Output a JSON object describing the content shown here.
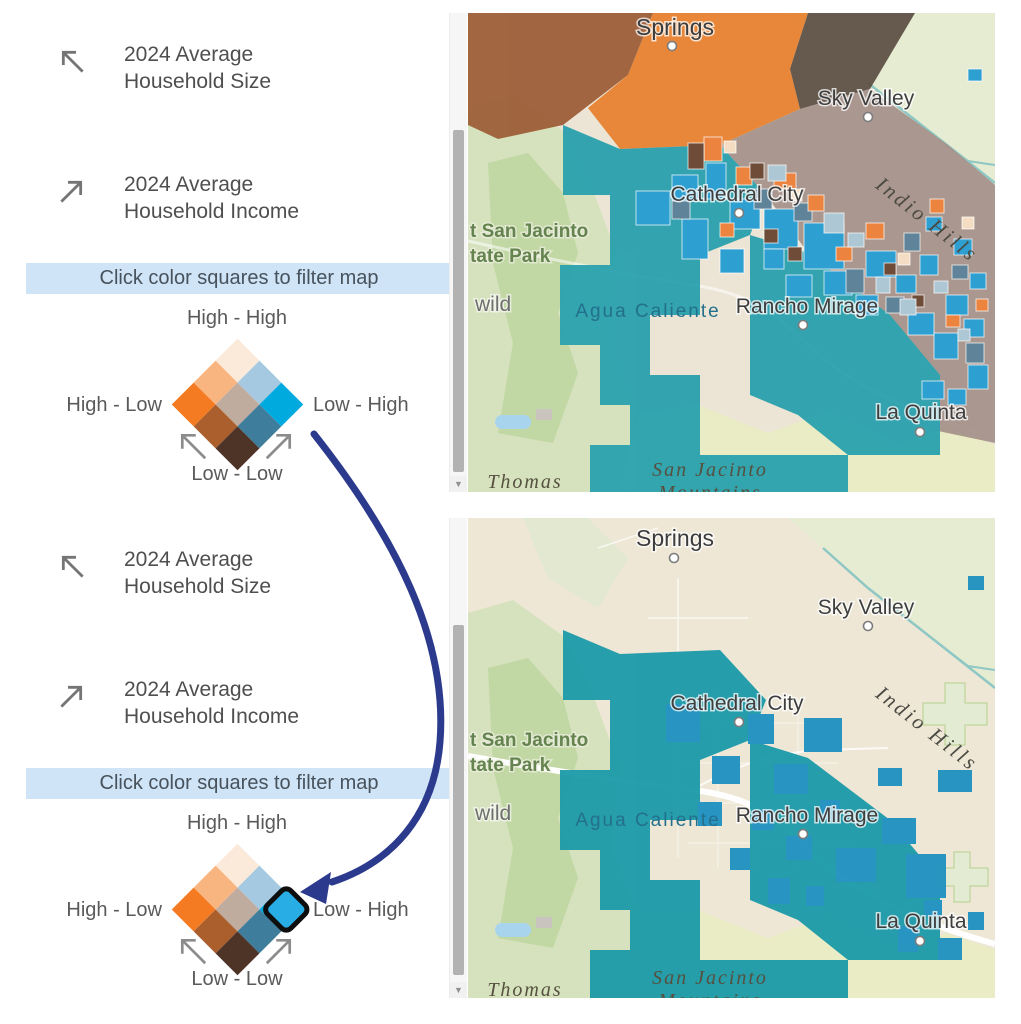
{
  "palette": {
    "banner_bg": "#cfe4f6",
    "annotation_arrow": "#2b3a8c",
    "map_teal": "#26a0ad",
    "map_cyan_tract": "#2e9fd1",
    "filtered_teal": "#1b9aa9",
    "filtered_cyan": "#1e90c0",
    "basemap_desert": "#ece4d4",
    "basemap_green": "#d6e2bd"
  },
  "legend": {
    "size_icon": "arrow-up-left",
    "income_icon": "arrow-up-right",
    "size_line1": "2024 Average",
    "size_line2": "Household Size",
    "income_line1": "2024 Average",
    "income_line2": "Household Income",
    "banner": "Click color squares to filter map",
    "high_high": "High - High",
    "high_low": "High - Low",
    "low_high": "Low - High",
    "low_low": "Low - Low",
    "matrix_colors": [
      [
        "#fbe9da",
        "#a5c9e1",
        "#00aade"
      ],
      [
        "#f8b57f",
        "#c0ab9f",
        "#3e7d9b"
      ],
      [
        "#f47b21",
        "#aa5f2d",
        "#4e3427"
      ]
    ],
    "selected": {
      "position": "low_high",
      "fill": "#29ade5"
    }
  },
  "map_labels": {
    "springs": "Springs",
    "sky_valley": "Sky Valley",
    "cathedral_city": "Cathedral City",
    "indio_hills": "Indio Hills",
    "state_park_line1": "t San Jacinto",
    "state_park_line2": "tate Park",
    "idyllwild": "wild",
    "agua_caliente": "Agua Caliente",
    "rancho_mirage": "Rancho Mirage",
    "la_quinta": "La Quinta",
    "mountains_line1": "San Jacinto",
    "mountains_line2": "Mountains",
    "thomas": "Thomas"
  }
}
